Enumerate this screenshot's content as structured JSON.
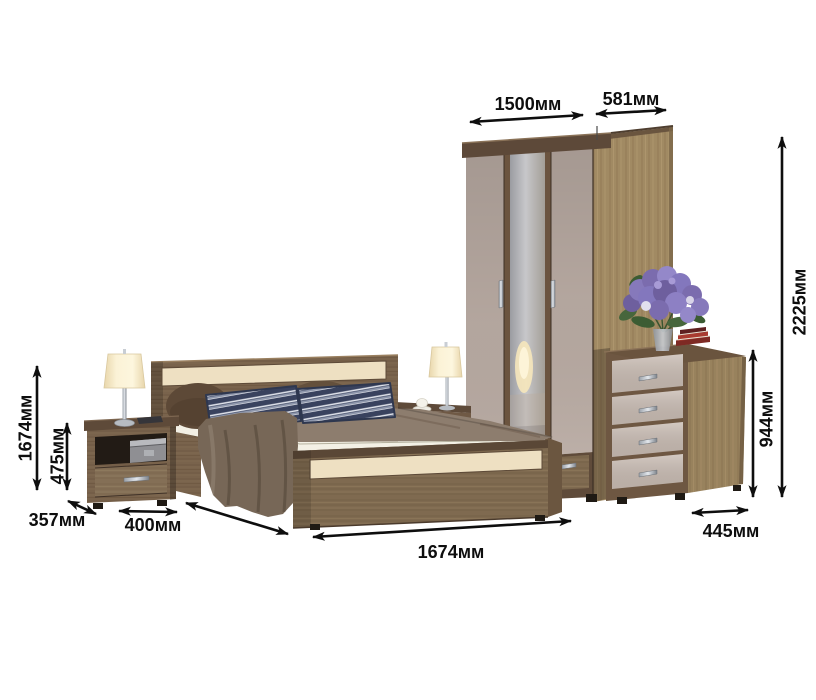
{
  "dimension_labels": {
    "wardrobe_width": "1500мм",
    "wardrobe_depth": "581мм",
    "wardrobe_height": "2225мм",
    "dresser_height": "944мм",
    "dresser_depth": "445мм",
    "bed_length": "1674мм",
    "bed_side_height": "1674мм",
    "nightstand_height": "475мм",
    "nightstand_depth": "357мм",
    "nightstand_width": "400мм"
  },
  "colors": {
    "background": "#ffffff",
    "dimension_ink": "#0e0e0e",
    "oak_wood": "#a18a63",
    "dark_wood": "#79634c",
    "cornice_wood": "#5b4737",
    "door_beige": "#b7a9a1",
    "drawer_beige": "#c9bcb3",
    "accent_cream": "#eee0c2",
    "blanket_taupe": "#8d7d6e",
    "drape_taupe": "#776757",
    "mattress_white": "#f3f0e5",
    "pillow_navy": "#39425e",
    "lamp_shade_cream": "#f8efd5",
    "flower_purple": "#8377bd",
    "leaf_green": "#47663c",
    "mirror_grey": "#b9b9bd",
    "chrome": "#c6cbd2"
  }
}
